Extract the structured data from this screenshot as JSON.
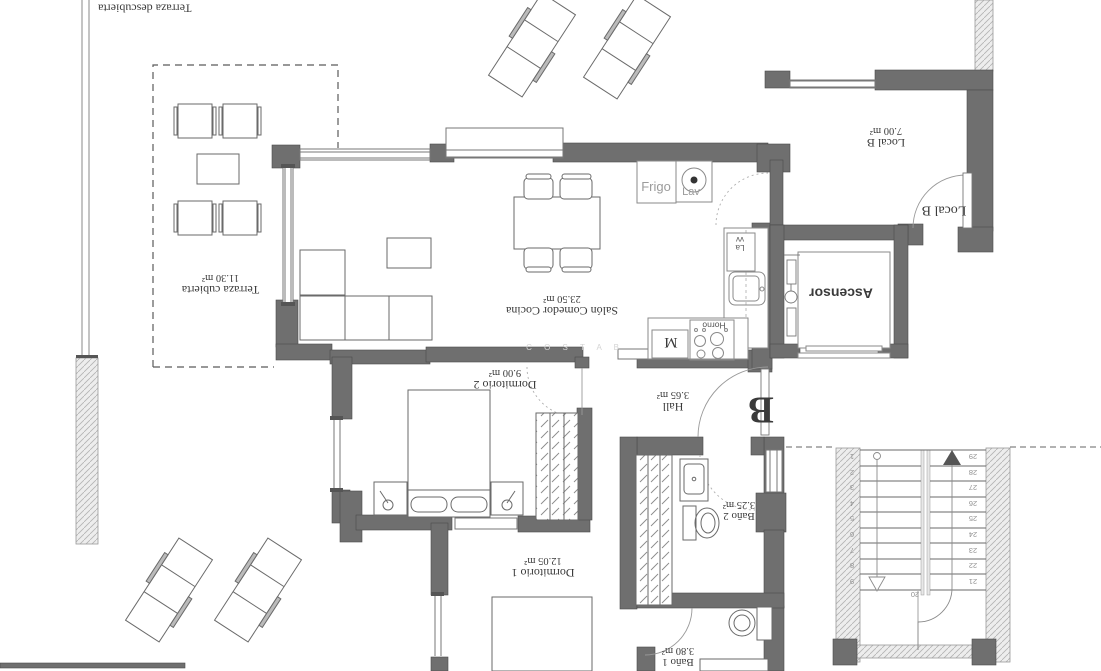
{
  "plan": {
    "apartment_letter": "B",
    "watermark": "C O S T A  B",
    "rooms": {
      "terraza_descubierta": {
        "name": "Terraza descubierta"
      },
      "terraza_cubierta": {
        "name": "Terraza cubierta",
        "area": "11.30 m²"
      },
      "salon": {
        "name": "Salón Comedor Cocina",
        "area": "23.50 m²"
      },
      "dormitorio2": {
        "name": "Dormitorio 2",
        "area": "9.00 m²"
      },
      "dormitorio1": {
        "name": "Dormitorio 1",
        "area": "12.05 m²"
      },
      "hall": {
        "name": "Hall",
        "area": "3.65 m²"
      },
      "bano2": {
        "name": "Baño 2",
        "area": "3.25 m²"
      },
      "bano1": {
        "name": "Baño 1",
        "area": "3.80 m²"
      },
      "local_b": {
        "name": "Local B",
        "area": "7.00 m²"
      }
    },
    "doors": {
      "local_b_door": "Local B"
    },
    "appliances": {
      "fridge": "Frigo",
      "washer": "Lav",
      "dishwasher": "Lavv",
      "oven": "Horno",
      "microwave": "M"
    },
    "elevator": {
      "label": "Ascensor"
    },
    "stairs": {
      "down_flight": [
        "1",
        "2",
        "3",
        "4",
        "5",
        "6",
        "7",
        "8",
        "9"
      ],
      "up_flight": [
        "29",
        "28",
        "27",
        "26",
        "25",
        "24",
        "23",
        "22",
        "21"
      ],
      "landing": "20"
    },
    "colors": {
      "wall": "#6f6f6f",
      "hatch_wall": "#ededed",
      "line": "#777777",
      "label": "#3a3a3a",
      "muted_label": "#9b9b9b",
      "watermark": "#d4d4d4",
      "background": "#ffffff"
    }
  }
}
